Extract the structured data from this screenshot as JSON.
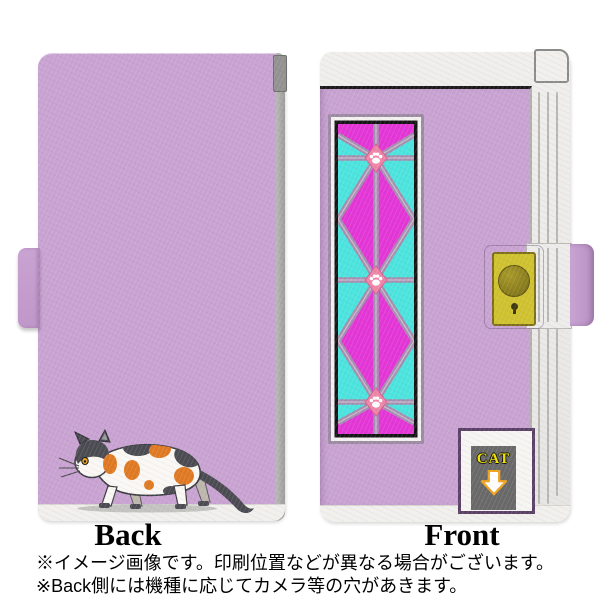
{
  "product": {
    "back_label": "Back",
    "front_label": "Front",
    "front_badge_text": "CAT",
    "notes": [
      "※イメージ画像です。印刷位置などが異なる場合がございます。",
      "※Back側には機種に応じてカメラ等の穴があきます。"
    ]
  },
  "icons": {
    "back_illustration": "calico-cat-walking",
    "panel_medallion": "paw-print",
    "badge_icon": "down-arrow",
    "clasp": "magnetic-clasp-button",
    "keyhole": "keyhole"
  },
  "colors": {
    "case_purple": "#c9a3d2",
    "pattern_magenta": "#e436d6",
    "pattern_cyan": "#4ce4de",
    "pattern_lattice": "#a48fae",
    "pattern_lattice_light": "#cdbad2",
    "paw_pink": "#ef85a8",
    "clasp_yellow": "#d0c22f",
    "badge_gray": "#696969",
    "badge_text_yellow": "#f2e200",
    "arrow_orange": "#f0a41e",
    "cat_orange": "#e07a22",
    "cat_dark": "#4b4b52",
    "edge_gray": "#a3a3a1"
  }
}
